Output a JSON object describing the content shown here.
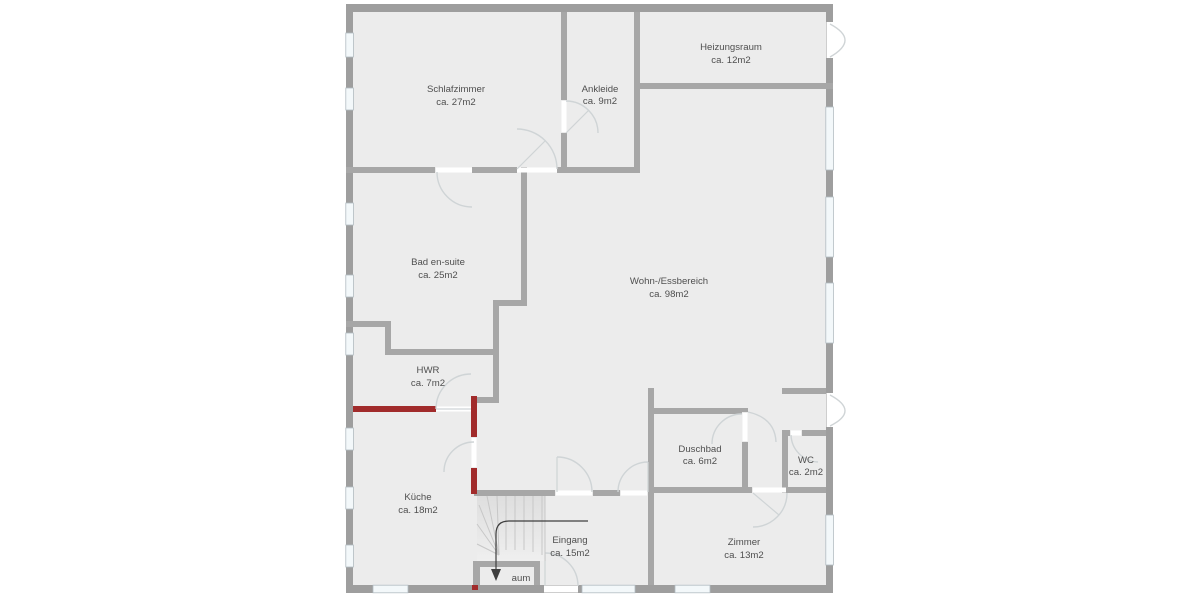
{
  "plan": {
    "type": "floor-plan",
    "language": "de"
  },
  "rooms": [
    {
      "id": "schlafzimmer",
      "name": "Schlafzimmer",
      "area": "ca. 27m2"
    },
    {
      "id": "ankleide",
      "name": "Ankleide",
      "area": "ca. 9m2"
    },
    {
      "id": "heizungsraum",
      "name": "Heizungsraum",
      "area": "ca. 12m2"
    },
    {
      "id": "bad-en-suite",
      "name": "Bad en-suite",
      "area": "ca. 25m2"
    },
    {
      "id": "wohn-essbereich",
      "name": "Wohn-/Essbereich",
      "area": "ca. 98m2"
    },
    {
      "id": "hwr",
      "name": "HWR",
      "area": "ca. 7m2"
    },
    {
      "id": "kueche",
      "name": "Küche",
      "area": "ca. 18m2"
    },
    {
      "id": "eingang",
      "name": "Eingang",
      "area": "ca. 15m2"
    },
    {
      "id": "duschbad",
      "name": "Duschbad",
      "area": "ca. 6m2"
    },
    {
      "id": "wc",
      "name": "WC",
      "area": "ca. 2m2"
    },
    {
      "id": "zimmer",
      "name": "Zimmer",
      "area": "ca. 13m2"
    }
  ],
  "partial_label": "aum",
  "colors": {
    "floor": "#ececec",
    "wall": "#a7a7a7",
    "wall_exterior": "#9e9e9e",
    "accent_red": "#a12b2b",
    "window": "#f3f8fa",
    "arc": "#cfd4d6",
    "label_text": "#4f4f4f"
  }
}
